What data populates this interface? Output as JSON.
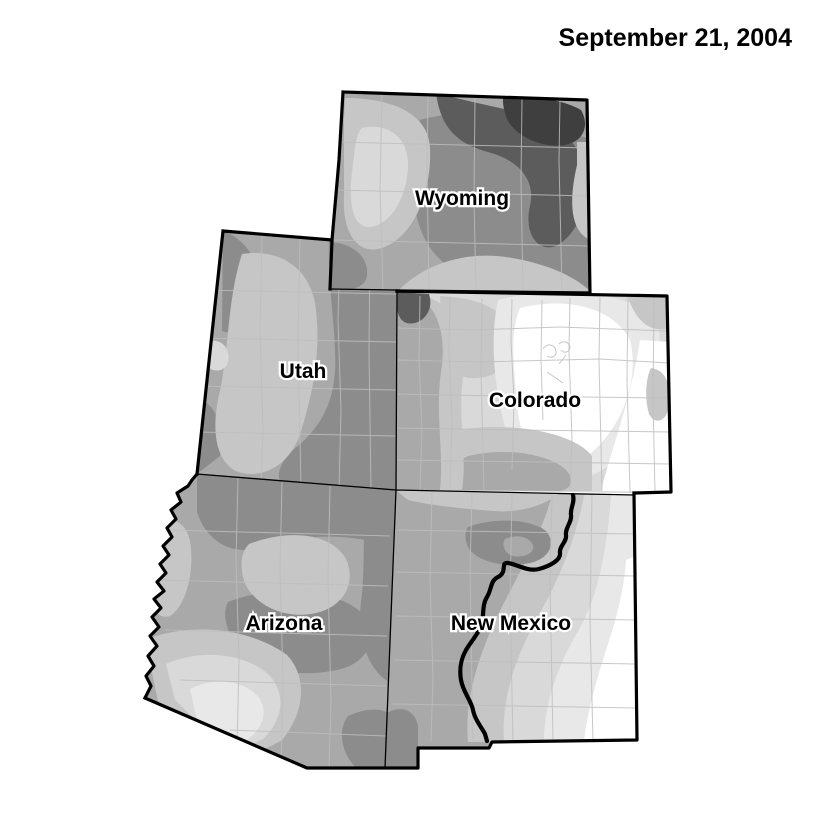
{
  "title": "September 21, 2004",
  "map": {
    "type": "choropleth-contour-map",
    "region": "Four Corners / Intermountain West states",
    "states": [
      {
        "id": "wyoming",
        "label": "Wyoming"
      },
      {
        "id": "utah",
        "label": "Utah"
      },
      {
        "id": "colorado",
        "label": "Colorado"
      },
      {
        "id": "arizona",
        "label": "Arizona"
      },
      {
        "id": "new-mexico",
        "label": "New Mexico"
      }
    ],
    "features": [
      {
        "id": "rio-grande-river",
        "type": "river-line"
      },
      {
        "id": "county-boundaries",
        "type": "admin-lines"
      }
    ]
  },
  "colors": {
    "background": "#ffffff",
    "border": "#000000",
    "county_line": "#bdbdbd",
    "title_color": "#000000",
    "shading_levels": [
      "#ffffff",
      "#e8e8e8",
      "#d9d9d9",
      "#c6c6c6",
      "#a9a9a9",
      "#8c8c8c",
      "#5c5c5c",
      "#3f3f3f"
    ]
  }
}
